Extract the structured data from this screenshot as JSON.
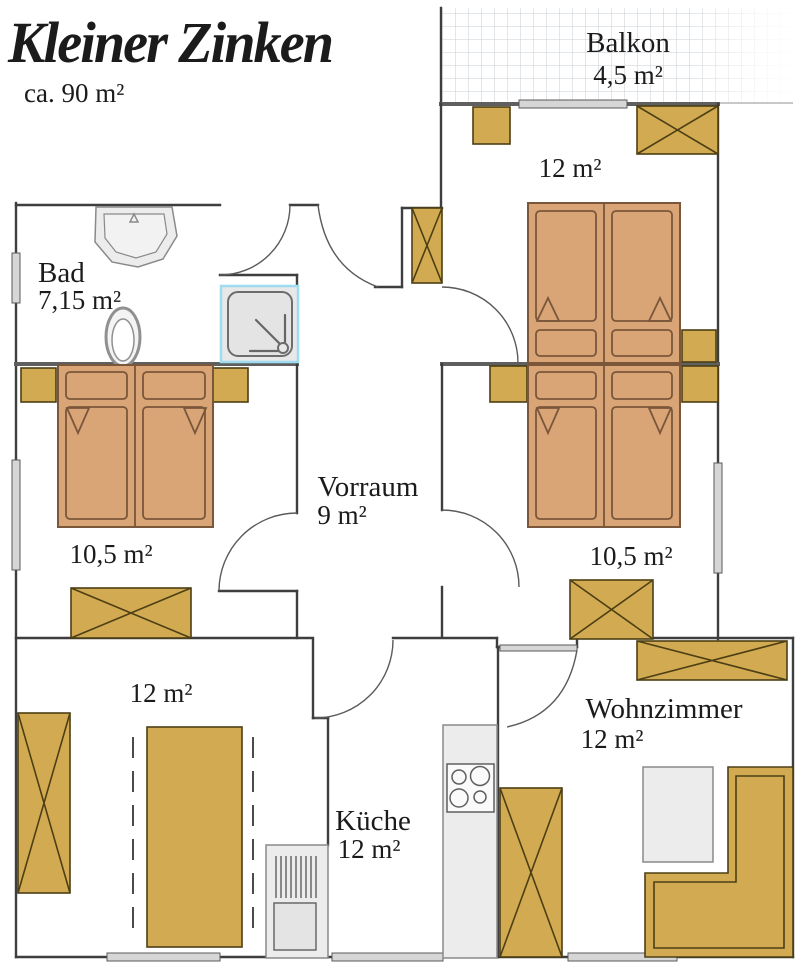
{
  "header": {
    "title": "Kleiner Zinken",
    "subtitle": "ca. 90 m²"
  },
  "palette": {
    "furniture": "#d2aa52",
    "furniture_stroke": "#4d3f14",
    "bed": "#d9a577",
    "bed_stroke": "#7a563a",
    "wall": "#3e3e3e",
    "gray_fill": "#ececec",
    "shower_accent": "#9fdcf0",
    "window_fill": "#d6d6d6",
    "grid": "#c9cfd6",
    "text": "#1b1b1b"
  },
  "rooms": {
    "balkon": {
      "name": "Balkon",
      "area": "4,5 m²"
    },
    "schlafzimmer_oben": {
      "area": "12 m²"
    },
    "bad": {
      "name": "Bad",
      "area": "7,15 m²"
    },
    "vorraum": {
      "name": "Vorraum",
      "area": "9 m²"
    },
    "schlafzimmer_links": {
      "area": "10,5 m²"
    },
    "schlafzimmer_rechts": {
      "area": "10,5 m²"
    },
    "zimmer_unten": {
      "area": "12 m²"
    },
    "kueche": {
      "name": "Küche",
      "area": "12 m²"
    },
    "wohnzimmer": {
      "name": "Wohnzimmer",
      "area": "12 m²"
    }
  }
}
